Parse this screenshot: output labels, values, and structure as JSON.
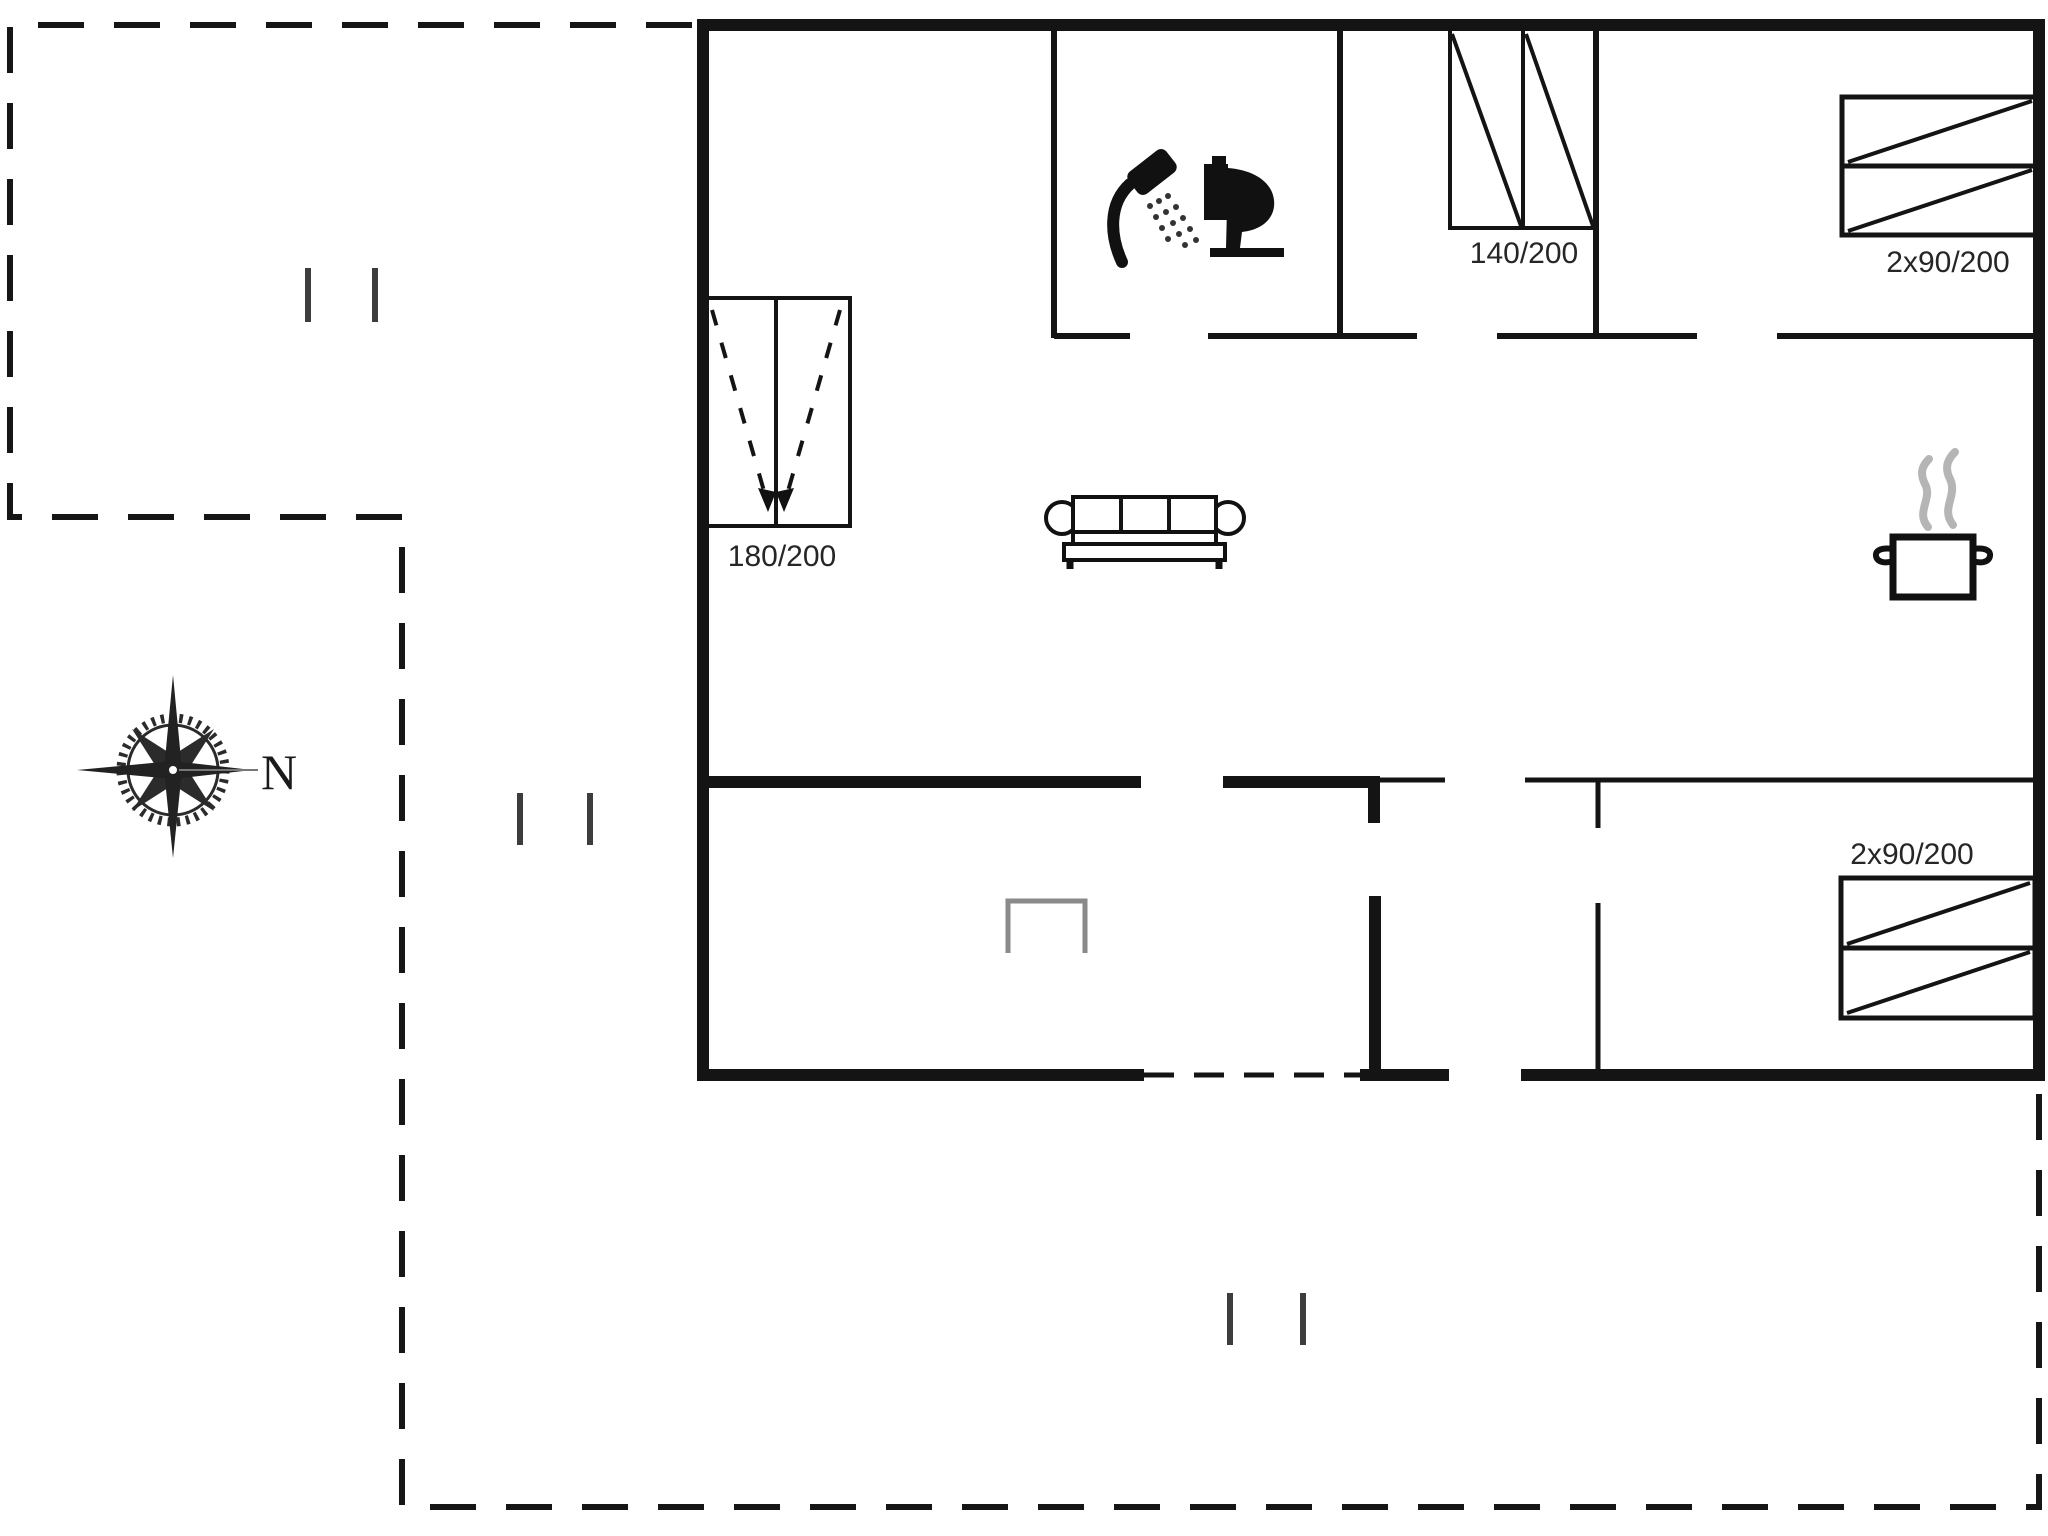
{
  "compass": {
    "label": "N"
  },
  "bed_labels": {
    "double_140": "140/200",
    "twin_top_right": "2x90/200",
    "double_180": "180/200",
    "twin_bottom_right": "2x90/200"
  },
  "icons": {
    "shower": "shower-icon",
    "toilet": "toilet-icon",
    "sofa": "sofa-icon",
    "cooking_pot": "cooking-pot-icon",
    "compass_rose": "compass-rose-icon",
    "niche": "niche-icon"
  },
  "colors": {
    "wall": "#141414",
    "furniture": "#141414",
    "steam_gray": "#b5b5b5",
    "detail_gray": "#8a8a8a",
    "text": "#262626",
    "background": "#ffffff"
  }
}
